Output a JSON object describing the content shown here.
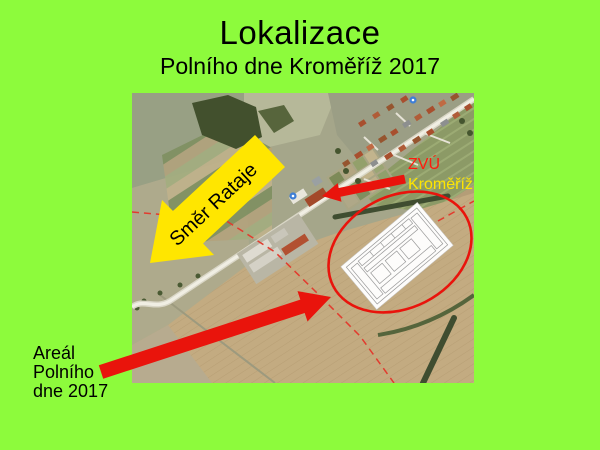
{
  "slide": {
    "title": "Lokalizace",
    "subtitle": "Polního dne Kroměříž 2017"
  },
  "labels": {
    "direction_arrow": "Směr Rataje",
    "zvu": {
      "line1": "ZVÚ",
      "line2": "Kroměříž"
    },
    "areal": {
      "line1": "Areál",
      "line2": "Polního",
      "line3": "dne 2017"
    }
  },
  "colors": {
    "slide_background": "#8DFB3C",
    "title_text": "#000000",
    "yellow_arrow": "#FFE600",
    "red_arrow": "#E9140C",
    "zvu_line1": "#FF1A0D",
    "zvu_line2": "#FFE600",
    "ellipse_stroke": "#E9140C",
    "areal_text": "#000000"
  },
  "map": {
    "type": "satellite-aerial-photo",
    "marker_icon": "blue-road-marker"
  }
}
